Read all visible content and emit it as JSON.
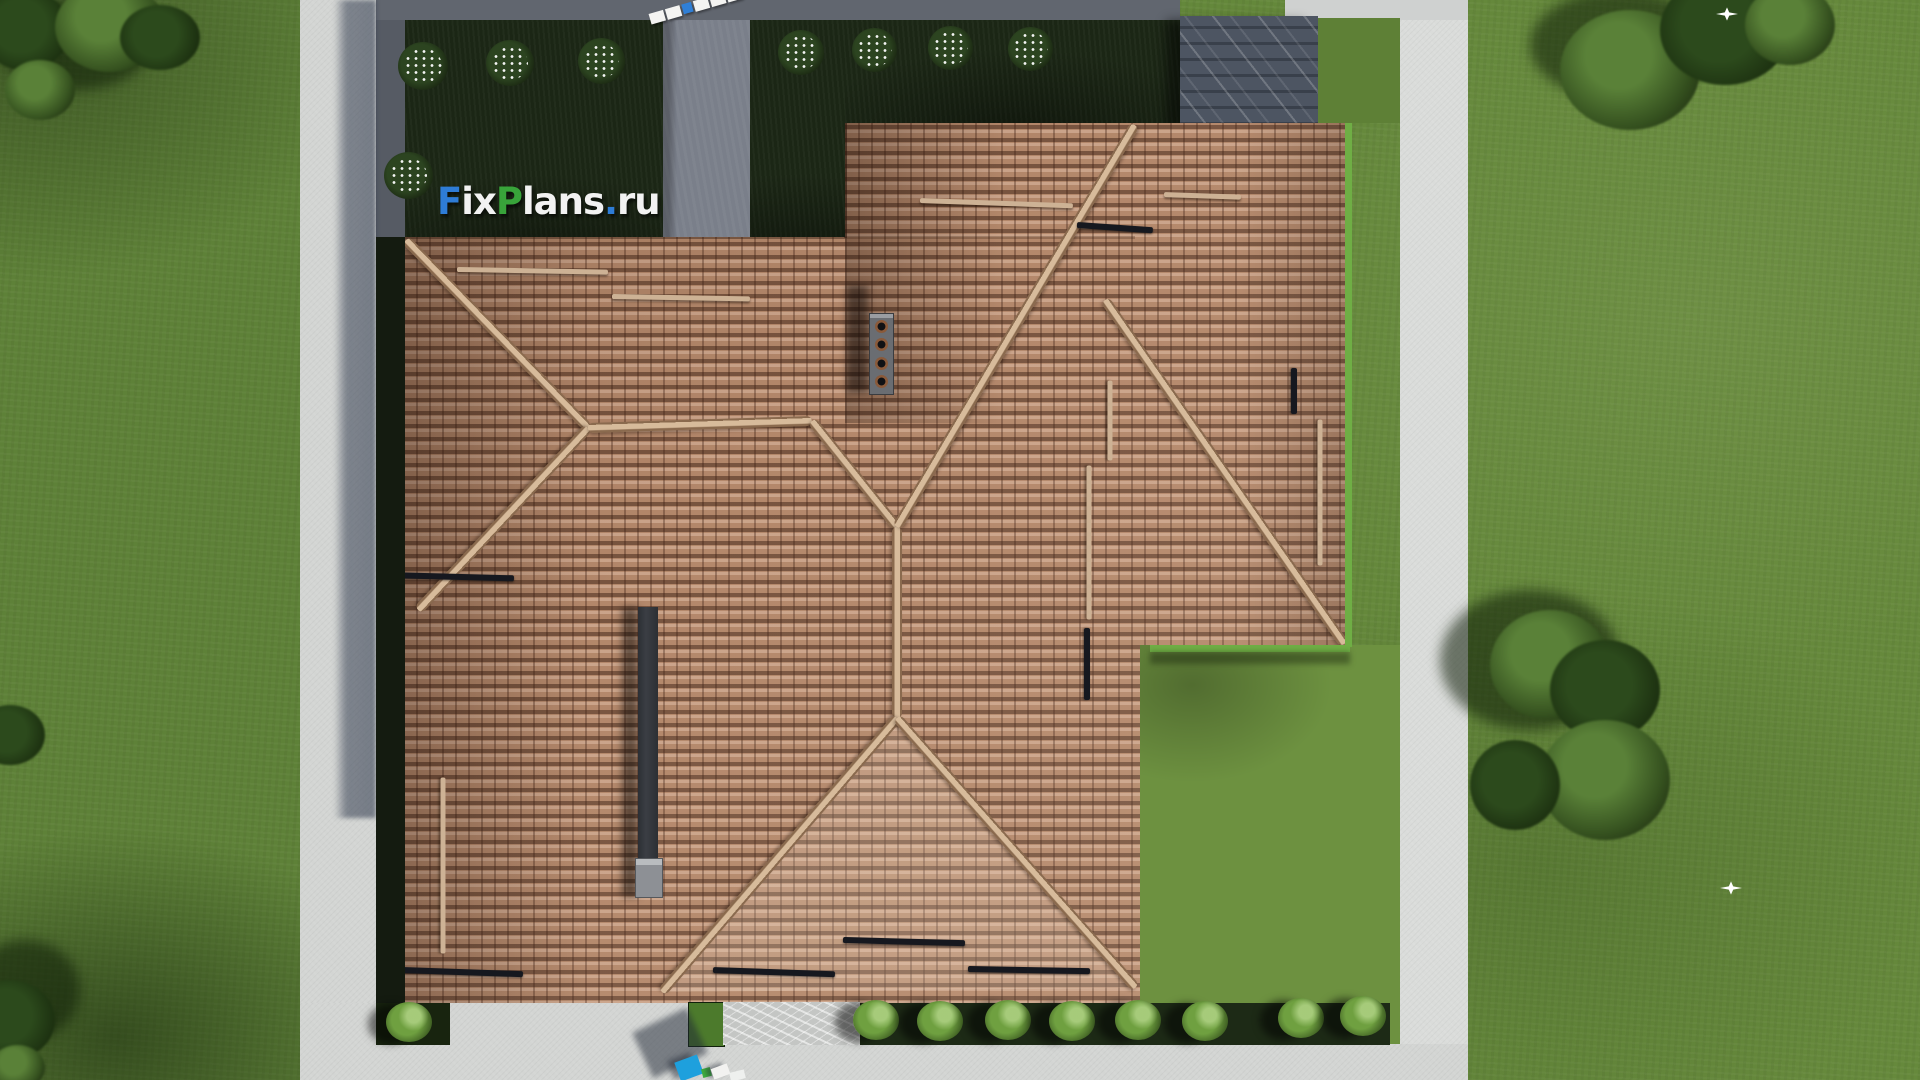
{
  "scene": {
    "type": "3d-aerial-architectural-render",
    "description": "Top-down aerial render of a house with complex terracotta hip roof, concrete sidewalks framing the lot, dark planted garden beds with white flowering shrubs, bottom hedge row, pergola, lawns with trees and two white birds"
  },
  "watermark": {
    "text": "FixPlans.ru",
    "segments": [
      {
        "text": "F",
        "color": "#2e7cd6"
      },
      {
        "text": "ix",
        "color": "#f2f2f2"
      },
      {
        "text": "P",
        "color": "#38a43a"
      },
      {
        "text": "lans",
        "color": "#f2f2f2"
      },
      {
        "text": ".",
        "color": "#2e7cd6"
      },
      {
        "text": "ru",
        "color": "#f2f2f2"
      }
    ]
  },
  "palette": {
    "roof_tile": "#b3876a",
    "roof_ridge": "#d7bb9b",
    "lawn": "#63873a",
    "lawn_sunlit": "#6d9140",
    "garden_bed": "#1b2615",
    "sidewalk": "#d3d5d3",
    "driveway": "#61666f",
    "walkway": "#7a7f8a",
    "pergola": "#4d5562",
    "hedge_bush": "#6fa040",
    "chimney_body": "#6a6d72",
    "flue_dark": "#33363b",
    "car_blue": "#1ea0dd",
    "car_green": "#3fae3f",
    "lawn_edging": "#6fae45"
  },
  "objects": {
    "chimney_left_pot_count": 7,
    "chimney_center_pot_count": 4,
    "flowering_bushes_count": 8,
    "hedge_bushes_count": 9,
    "bird_count": 2
  }
}
